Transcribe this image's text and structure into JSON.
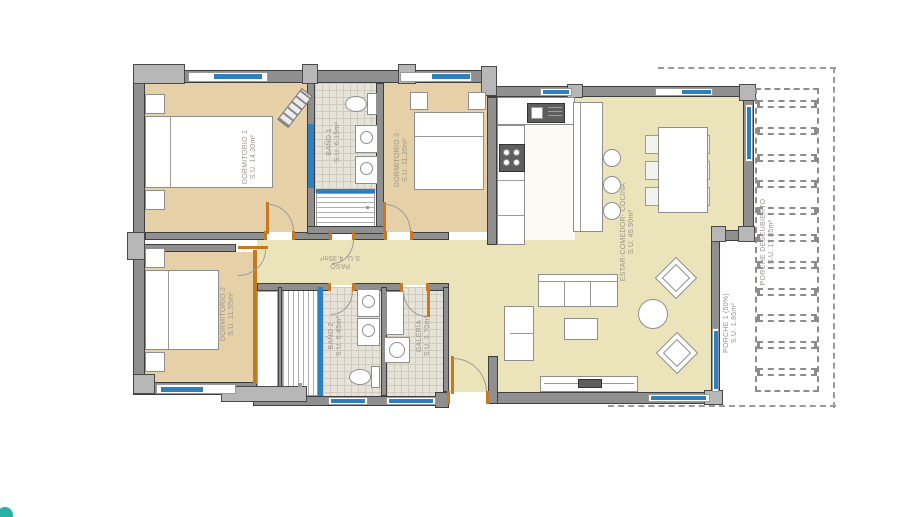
{
  "rooms": {
    "dormitorio1": {
      "label": "DORMITORIO 1",
      "area": "S.U. 14.30m²"
    },
    "bano1": {
      "label": "BAÑO 1",
      "area": "S.U. 6.15m²"
    },
    "dormitorio3": {
      "label": "DORMITORIO 3",
      "area": "S.U. 11.20m²"
    },
    "estar_comedor_cocina": {
      "label": "ESTAR-COMEDOR- COCINA",
      "area": "S.U. 45.90m²"
    },
    "paso": {
      "label": "PASO",
      "area": "S.U. 4.35m²"
    },
    "dormitorio2": {
      "label": "DORMITORIO 2",
      "area": "S.U. 11.55m²"
    },
    "bano2": {
      "label": "BAÑO 2",
      "area": "S.U. 6.45m²"
    },
    "galeria": {
      "label": "GALERÍA",
      "area": "S.U. 3.70m²"
    },
    "porche1": {
      "label": "PORCHE 1 (50%)",
      "area": "S.U. 1.85m²"
    },
    "porche_descubierto": {
      "label": "PORCHE DESCUBIERTO",
      "area": "S.U. 17.85m²"
    }
  },
  "colors": {
    "window_glass": "#2e7fc0",
    "door_wood": "#c8781e",
    "wall": "#8f8f8f",
    "bedroom_floor": "#e6d0a8",
    "living_floor": "#ebe4ba",
    "tile_floor": "#e7e3d8",
    "logo_teal": "#29b2a4"
  }
}
